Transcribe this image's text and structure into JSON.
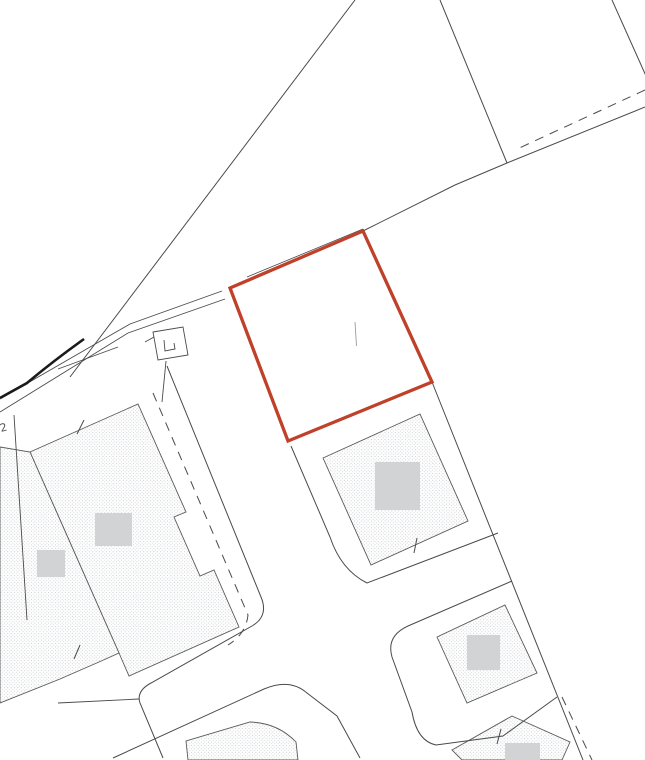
{
  "canvas": {
    "width": 645,
    "height": 760,
    "background": "#ffffff"
  },
  "palette": {
    "line": "#4a4a4a",
    "building_stroke": "#5a5a5a",
    "stipple_dot_a": "#bfc2c6",
    "stipple_dot_b": "#caccd0",
    "roof_fill": "#d2d3d4",
    "thick_line": "#1a1a1a",
    "highlight": "#bf4129",
    "label_color": "#555555"
  },
  "highlight_plot": {
    "name": "highlighted-plot-boundary",
    "points": "363,231 432,382 288,441 230,288",
    "stroke_width": 3.3,
    "inner_mark": {
      "x1": 355,
      "y1": 322,
      "x2": 356.5,
      "y2": 346
    }
  },
  "buildings": [
    {
      "name": "building-block-west-main",
      "type": "polygon",
      "points": "30,452 138,404 186,512 174,517 200,576 214,570 239,627 129,676 119,653 111,635"
    },
    {
      "name": "building-block-west-annex",
      "type": "polygon",
      "points": "0,447 30,452 111,635 119,653 99,662 60,679 0,703"
    },
    {
      "name": "building-plot-center",
      "type": "polygon",
      "points": "323,458 420,414 468,521 371,565"
    },
    {
      "name": "building-plot-southeast",
      "type": "polygon",
      "points": "437,637 505,605 537,673 467,703"
    },
    {
      "name": "building-bottom-right",
      "type": "polygon",
      "points": "512,716 570,742 562,760 462,760 452,750"
    },
    {
      "name": "building-bottom-center",
      "type": "path",
      "d": "M188,760 L186,741 L250,722 Q278,723 296,742 L298,760 Z"
    }
  ],
  "roof_squares": [
    {
      "name": "roof-square-west-1",
      "x": 95,
      "y": 513,
      "w": 37,
      "h": 33
    },
    {
      "name": "roof-square-west-2",
      "x": 37,
      "y": 550,
      "w": 28,
      "h": 27
    },
    {
      "name": "roof-square-center",
      "x": 375,
      "y": 462,
      "w": 45,
      "h": 48
    },
    {
      "name": "roof-square-southeast",
      "x": 467,
      "y": 635,
      "w": 33,
      "h": 35
    },
    {
      "name": "roof-square-bottom-right",
      "x": 505,
      "y": 743,
      "w": 35,
      "h": 17
    }
  ],
  "lines": [
    {
      "name": "field-boundary-diagonal",
      "d": "M355,0 L70,377",
      "dashed": false,
      "width": 1
    },
    {
      "name": "field-boundary-north",
      "d": "M440,0 L507,163",
      "dashed": false,
      "width": 1
    },
    {
      "name": "field-boundary-northeast",
      "d": "M612,0 L646,76",
      "dashed": false,
      "width": 1
    },
    {
      "name": "overlay-boundary-dashed-top",
      "d": "M645,90 L515,150",
      "dashed": true,
      "width": 1
    },
    {
      "name": "site-boundary-main",
      "d": "M645,107 L507,163 L455,185 L363,231",
      "dashed": false,
      "width": 1
    },
    {
      "name": "site-boundary-along-plot-edge",
      "d": "M363,229 L247,277",
      "dashed": false,
      "width": 0.8
    },
    {
      "name": "track-edge-upper",
      "d": "M222,291 L130,324 L0,399",
      "dashed": false,
      "width": 0.9
    },
    {
      "name": "track-edge-lower",
      "d": "M225,299 L128,333 L0,412",
      "dashed": false,
      "width": 0.9
    },
    {
      "name": "track-centre-segment",
      "d": "M118,347 L58,369",
      "dashed": false,
      "width": 0.8
    },
    {
      "name": "kerb-thick-line",
      "d": "M84,339 Q52,362 27,383 L0,398",
      "dashed": false,
      "width": 2.6,
      "color_key": "thick_line"
    },
    {
      "name": "plot-division-west",
      "d": "M14,415 L27,620",
      "dashed": false,
      "width": 0.9
    },
    {
      "name": "road-edge-east-of-west-block",
      "d": "M167,366 L261,597 Q269,616 252,626 L151,683 Q136,691 140,703 L163,758",
      "dashed": false,
      "width": 1
    },
    {
      "name": "verge-dashed-west-block",
      "d": "M153,393 L248,615 Q246,634 228,645",
      "dashed": true,
      "width": 1
    },
    {
      "name": "road-edge-southwest",
      "d": "M139,699 L58,703",
      "dashed": false,
      "width": 0.9
    },
    {
      "name": "road-edge-bottom-plot",
      "d": "M113,758 L264,689 Q290,678 307,693 L337,716 L360,758",
      "dashed": false,
      "width": 1
    },
    {
      "name": "plot-boundary-center",
      "d": "M291,446 L330,537 Q341,570 367,583 L498,533",
      "dashed": false,
      "width": 1
    },
    {
      "name": "plot-boundary-east-column",
      "d": "M432,382 L583,760",
      "dashed": false,
      "width": 1
    },
    {
      "name": "plot-boundary-southeast",
      "d": "M512,581 L408,626 Q386,636 392,657 L412,712 Q417,741 436,745 L503,736 L557,697",
      "dashed": false,
      "width": 1
    },
    {
      "name": "overlay-boundary-dashed-bottom",
      "d": "M562,697 L592,760",
      "dashed": true,
      "width": 1
    },
    {
      "name": "outbuilding-outline",
      "d": "M153,332 L183,327 L188,355 L158,360 Z",
      "dashed": false,
      "width": 0.9
    },
    {
      "name": "outbuilding-inner-mark",
      "d": "M164,340 L165,351 L175,349 L174,343",
      "dashed": false,
      "width": 0.9
    },
    {
      "name": "outbuilding-arrow-mark",
      "d": "M154,337 L145,342",
      "dashed": false,
      "width": 0.9
    },
    {
      "name": "outbuilding-stem",
      "d": "M166,361 L162,402",
      "dashed": false,
      "width": 0.9
    }
  ],
  "ticks": [
    {
      "name": "survey-tick-1",
      "x1": 84,
      "y1": 420,
      "x2": 77,
      "y2": 434
    },
    {
      "name": "survey-tick-2",
      "x1": 80,
      "y1": 645,
      "x2": 74,
      "y2": 659
    },
    {
      "name": "survey-tick-3",
      "x1": 417,
      "y1": 538,
      "x2": 414,
      "y2": 553
    },
    {
      "name": "survey-tick-4",
      "x1": 501,
      "y1": 729,
      "x2": 497,
      "y2": 744
    }
  ],
  "labels": [
    {
      "name": "partial-label-2",
      "text": "2",
      "x": 1,
      "y": 432,
      "rotate": -15,
      "size": 11
    },
    {
      "name": "partial-label-s",
      "text": "S",
      "x": -2,
      "y": 596,
      "rotate": -60,
      "size": 11
    }
  ]
}
